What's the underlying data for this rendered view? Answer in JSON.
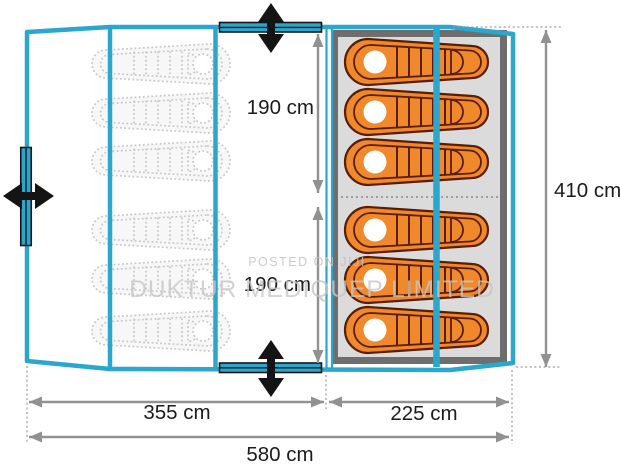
{
  "diagram": {
    "type": "tent-floorplan-top-view",
    "total_width_label": "580 cm",
    "total_depth_label": "410 cm",
    "sections": [
      {
        "name": "porch-living-area",
        "width_label": "355 cm",
        "sleeping_bags": {
          "style": "outline-ghost",
          "count": 6
        }
      },
      {
        "name": "sleeping-cabin",
        "width_label": "225 cm",
        "compartments": [
          {
            "length_label": "190 cm",
            "bags": 3
          },
          {
            "length_label": "190 cm",
            "bags": 3
          }
        ],
        "sleeping_bags": {
          "style": "orange-mummy",
          "count": 6
        }
      }
    ],
    "doors": {
      "count": 3,
      "positions": [
        "top",
        "bottom",
        "left"
      ]
    }
  },
  "labels": {
    "dim_inner_top": "190 cm",
    "dim_inner_bottom": "190 cm",
    "dim_height": "410 cm",
    "dim_width_left": "355 cm",
    "dim_width_right": "225 cm",
    "dim_width_total": "580 cm"
  },
  "watermark": {
    "line1": "POSTED ON JIJI",
    "line2": "DUKTUR MEDIQUEP LIMITED"
  },
  "colors": {
    "tent_outline": "#2BA7CE",
    "sleeping_bag": "#F0882C",
    "sleeping_bag_outline": "#5A1D02",
    "inner_tent_fill": "#DBDBDB",
    "inner_tent_border": "#6E6E6E",
    "ghost_bag": "#C8C8C8",
    "dimension_grey": "#919191",
    "arrow_black": "#141414"
  }
}
